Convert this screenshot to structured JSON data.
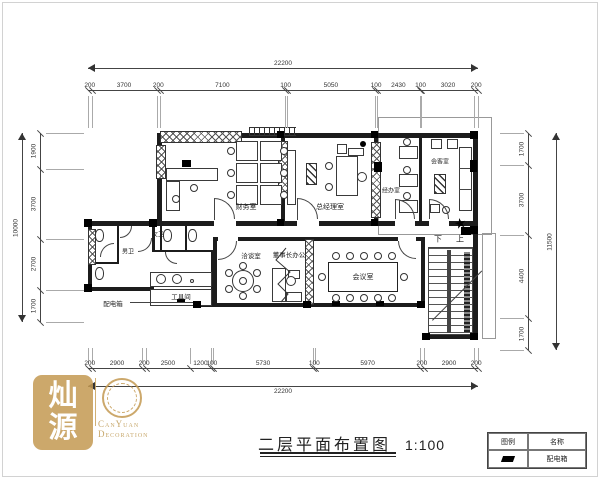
{
  "title": {
    "text": "二层平面布置图",
    "scale": "1:100"
  },
  "rooms": {
    "finance": "财务室",
    "general_manager": "总经理室",
    "staff_office": "经办室",
    "reception": "会客室",
    "womens_wc": "女卫",
    "mens_wc": "男卫",
    "tool_room": "工具间",
    "negotiation": "洽谈室",
    "chairman_office": "董事长办公",
    "conference": "会议室"
  },
  "stairs": {
    "down": "下",
    "up": "上"
  },
  "equipment": {
    "distribution_box": "配电箱"
  },
  "legend": {
    "header_symbol": "图例",
    "header_name": "名称",
    "item_name": "配电箱"
  },
  "logo": {
    "seal_char1": "灿",
    "seal_char2": "源",
    "brand_line1": "CanYuan",
    "brand_line2": "Decoration",
    "gold": "#c49a52"
  },
  "dimensions": {
    "top_total": "22200",
    "top_segments": [
      "200",
      "3700",
      "200",
      "7100",
      "100",
      "5050",
      "100",
      "2430",
      "100",
      "3020",
      "200"
    ],
    "bottom_segments": [
      "200",
      "2900",
      "200",
      "2500",
      "1200",
      "100",
      "5730",
      "100",
      "5970",
      "200",
      "2900",
      "200"
    ],
    "bottom_total": "22200",
    "left_segments": [
      "1900",
      "3700",
      "2700",
      "1700"
    ],
    "left_total": "10000",
    "right_segments": [
      "1700",
      "3700",
      "4400",
      "1700"
    ],
    "right_total": "11500"
  }
}
